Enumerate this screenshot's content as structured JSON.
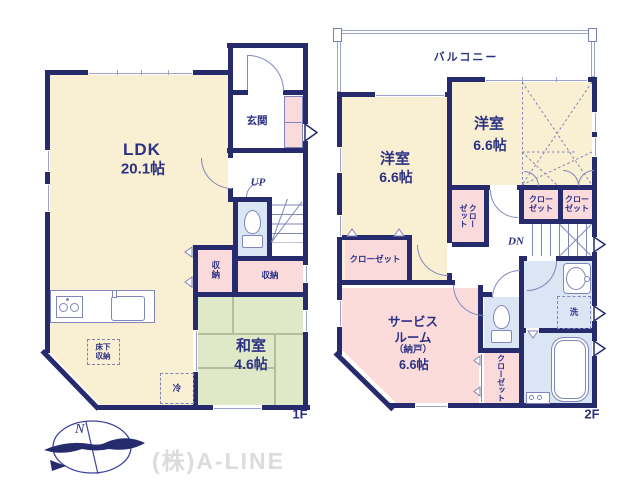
{
  "company": "(株)A-LINE",
  "compass": {
    "north": "N"
  },
  "floor1": {
    "label": "1F",
    "ldk": {
      "name": "LDK",
      "area": "20.1帖"
    },
    "entrance": "玄関",
    "stairs_up": "UP",
    "storage_left": "収納",
    "storage_right": "収納",
    "washitsu": {
      "name": "和室",
      "area": "4.6帖"
    },
    "underfloor_storage": "床下\n収納",
    "fridge": "冷"
  },
  "floor2": {
    "label": "2F",
    "balcony": "バルコニー",
    "bedroom_left": {
      "name": "洋室",
      "area": "6.6帖"
    },
    "bedroom_top": {
      "name": "洋室",
      "area": "6.6帖"
    },
    "closet_bedroom_left": "クローゼット",
    "closet_hall": "クロー\nゼット",
    "closet_a": "クロー\nゼット",
    "closet_b": "クロー\nゼット",
    "closet_service": "クローゼット",
    "stairs_down": "DN",
    "laundry": "洗",
    "service_room": {
      "line1": "サービス",
      "line2": "ルーム",
      "line3": "（納戸）",
      "area": "6.6帖"
    }
  }
}
